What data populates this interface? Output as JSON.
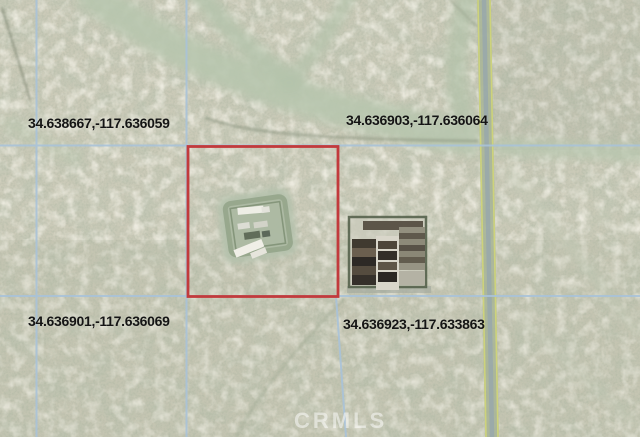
{
  "map": {
    "type": "satellite-aerial-view",
    "corner_labels": [
      {
        "position": "northwest",
        "text": "34.638667,-117.636059"
      },
      {
        "position": "northeast",
        "text": "34.636903,-117.636064"
      },
      {
        "position": "southwest",
        "text": "34.636901,-117.636069"
      },
      {
        "position": "southeast",
        "text": "34.636923,-117.633863"
      }
    ],
    "watermark": "CRMLS",
    "colors": {
      "highlight_boundary": "#c23a3c",
      "parcel_grid_line": "#a9c3d9",
      "label_text": "#151515",
      "watermark_text": "#ffffff",
      "terrain_base": "#c8c8b6"
    },
    "features": [
      "red-highlight-parcel-boundary",
      "parcel-grid-lines",
      "dirt-road-north-south",
      "desert-wash",
      "homestead-compound",
      "farm-compound"
    ]
  }
}
